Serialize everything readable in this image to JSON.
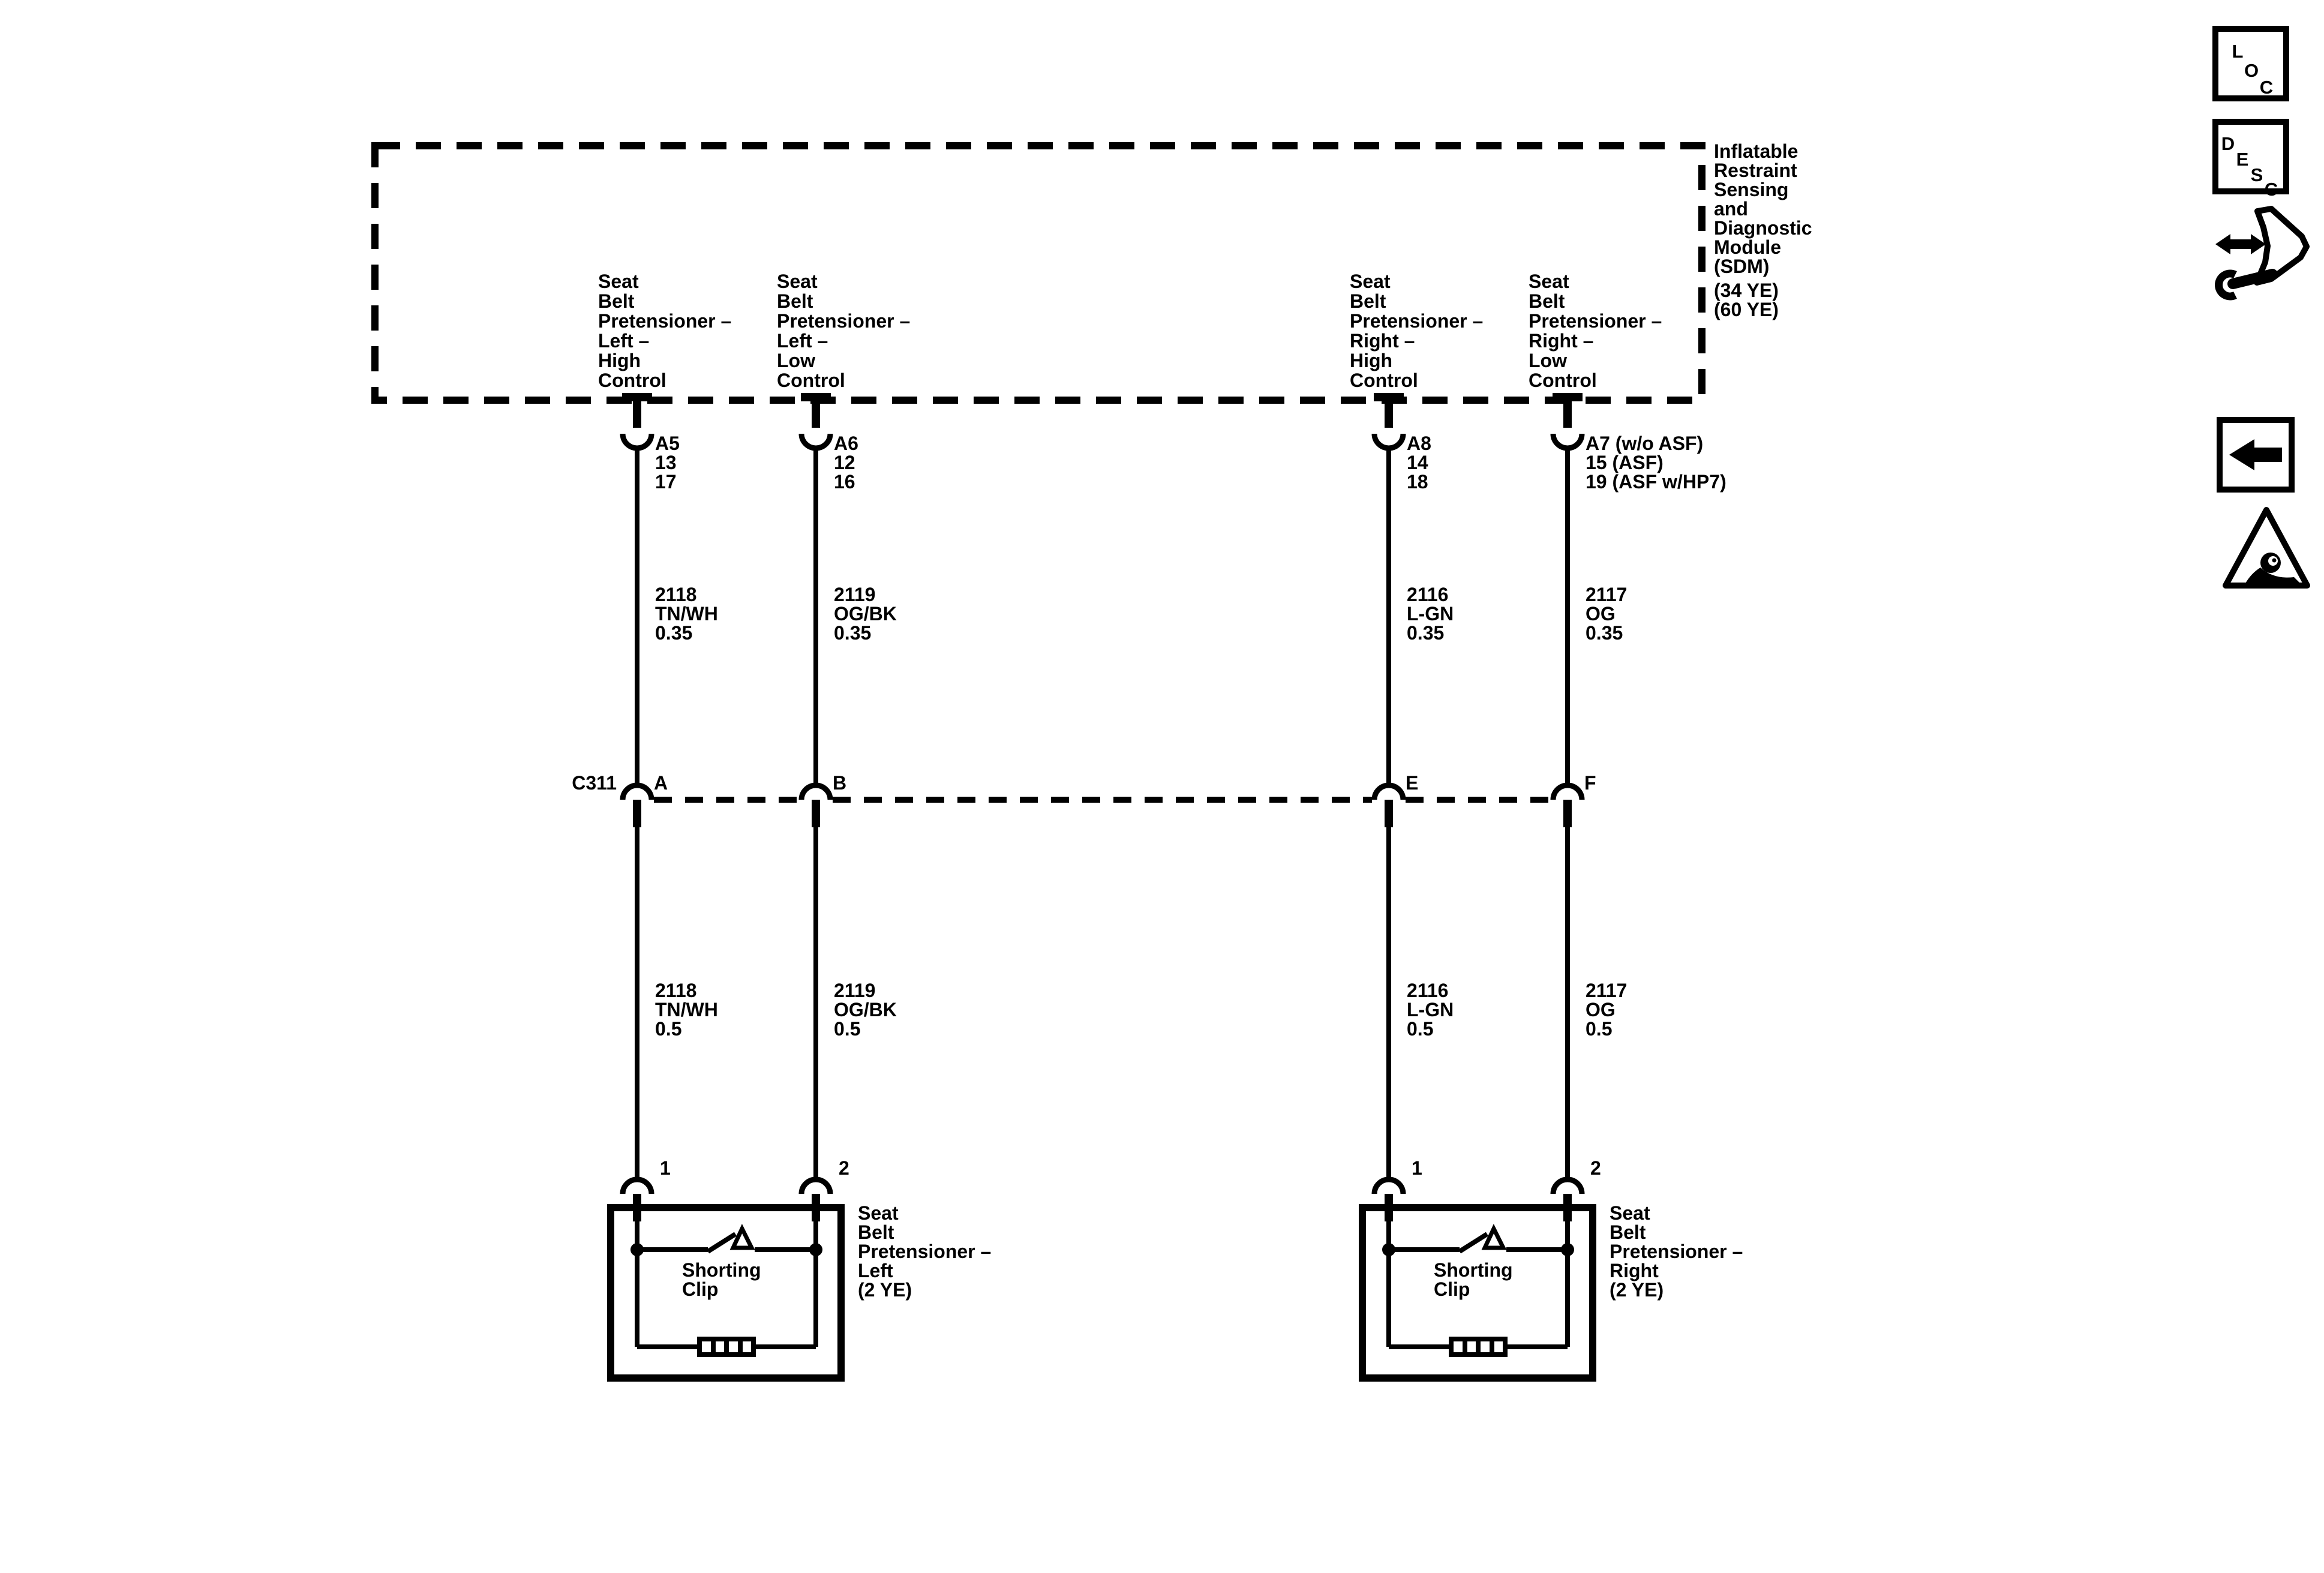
{
  "page": {
    "background": "#ffffff",
    "ink": "#000000"
  },
  "module": {
    "name_lines": [
      "Inflatable",
      "Restraint",
      "Sensing",
      "and",
      "Diagnostic",
      "Module",
      "(SDM)",
      "(34 YE)",
      "(60 YE)"
    ]
  },
  "sdm_pins": [
    {
      "control_lines": [
        "Seat",
        "Belt",
        "Pretensioner –",
        "Left –",
        "High",
        "Control"
      ],
      "pin_lines": [
        "A5",
        "13",
        "17"
      ]
    },
    {
      "control_lines": [
        "Seat",
        "Belt",
        "Pretensioner –",
        "Left –",
        "Low",
        "Control"
      ],
      "pin_lines": [
        "A6",
        "12",
        "16"
      ]
    },
    {
      "control_lines": [
        "Seat",
        "Belt",
        "Pretensioner –",
        "Right –",
        "High",
        "Control"
      ],
      "pin_lines": [
        "A8",
        "14",
        "18"
      ]
    },
    {
      "control_lines": [
        "Seat",
        "Belt",
        "Pretensioner –",
        "Right –",
        "Low",
        "Control"
      ],
      "pin_lines": [
        "A7 (w/o ASF)",
        "15 (ASF)",
        "19 (ASF w/HP7)"
      ]
    }
  ],
  "upper_wires": [
    {
      "circuit": "2118",
      "color": "TN/WH",
      "size": "0.35"
    },
    {
      "circuit": "2119",
      "color": "OG/BK",
      "size": "0.35"
    },
    {
      "circuit": "2116",
      "color": "L-GN",
      "size": "0.35"
    },
    {
      "circuit": "2117",
      "color": "OG",
      "size": "0.35"
    }
  ],
  "connector": {
    "name": "C311",
    "pins": [
      "A",
      "B",
      "E",
      "F"
    ]
  },
  "lower_wires": [
    {
      "circuit": "2118",
      "color": "TN/WH",
      "size": "0.5"
    },
    {
      "circuit": "2119",
      "color": "OG/BK",
      "size": "0.5"
    },
    {
      "circuit": "2116",
      "color": "L-GN",
      "size": "0.5"
    },
    {
      "circuit": "2117",
      "color": "OG",
      "size": "0.5"
    }
  ],
  "components": [
    {
      "pin_numbers": [
        "1",
        "2"
      ],
      "inner_label_lines": [
        "Shorting",
        "Clip"
      ],
      "label_lines": [
        "Seat",
        "Belt",
        "Pretensioner –",
        "Left",
        "(2 YE)"
      ]
    },
    {
      "pin_numbers": [
        "1",
        "2"
      ],
      "inner_label_lines": [
        "Shorting",
        "Clip"
      ],
      "label_lines": [
        "Seat",
        "Belt",
        "Pretensioner –",
        "Right",
        "(2 YE)"
      ]
    }
  ],
  "toolbar": {
    "loc_letters": [
      "L",
      "O",
      "C"
    ],
    "desc_letters": [
      "D",
      "E",
      "S",
      "C"
    ]
  }
}
